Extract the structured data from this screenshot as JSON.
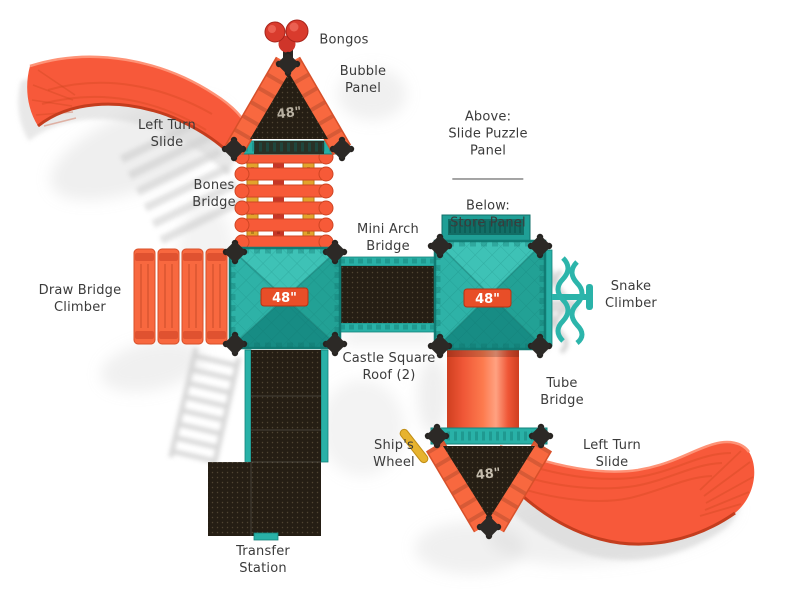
{
  "diagram": {
    "labels": {
      "bongos": "Bongos",
      "bubble_panel": "Bubble\nPanel",
      "left_turn_slide_top": "Left Turn\nSlide",
      "bones_bridge": "Bones\nBridge",
      "panel_above": "Above:\nSlide Puzzle\nPanel",
      "panel_below": "Below:\nStore Panel",
      "mini_arch_bridge": "Mini Arch\nBridge",
      "draw_bridge_climber": "Draw Bridge\nClimber",
      "snake_climber": "Snake\nClimber",
      "castle_square_roof": "Castle Square\nRoof (2)",
      "tube_bridge": "Tube\nBridge",
      "ships_wheel": "Ship's\nWheel",
      "left_turn_slide_bottom": "Left Turn\nSlide",
      "transfer_station": "Transfer\nStation"
    },
    "deck_heights": {
      "top_triangle_roof": "48\"",
      "left_square_roof": "48\"",
      "right_square_roof": "48\"",
      "bottom_triangle_roof": "48\""
    },
    "colors": {
      "slide_orange": "#f7593a",
      "roof_edge_orange": "#f8683f",
      "roof_teal": "#2ab3a9",
      "panel_dark": "#251e14",
      "bongo_red": "#d93b2d",
      "rail_yellow": "#e2a32c",
      "badge_red": "#e84e28",
      "label_text": "#3b3b3b",
      "background": "#ffffff"
    }
  }
}
